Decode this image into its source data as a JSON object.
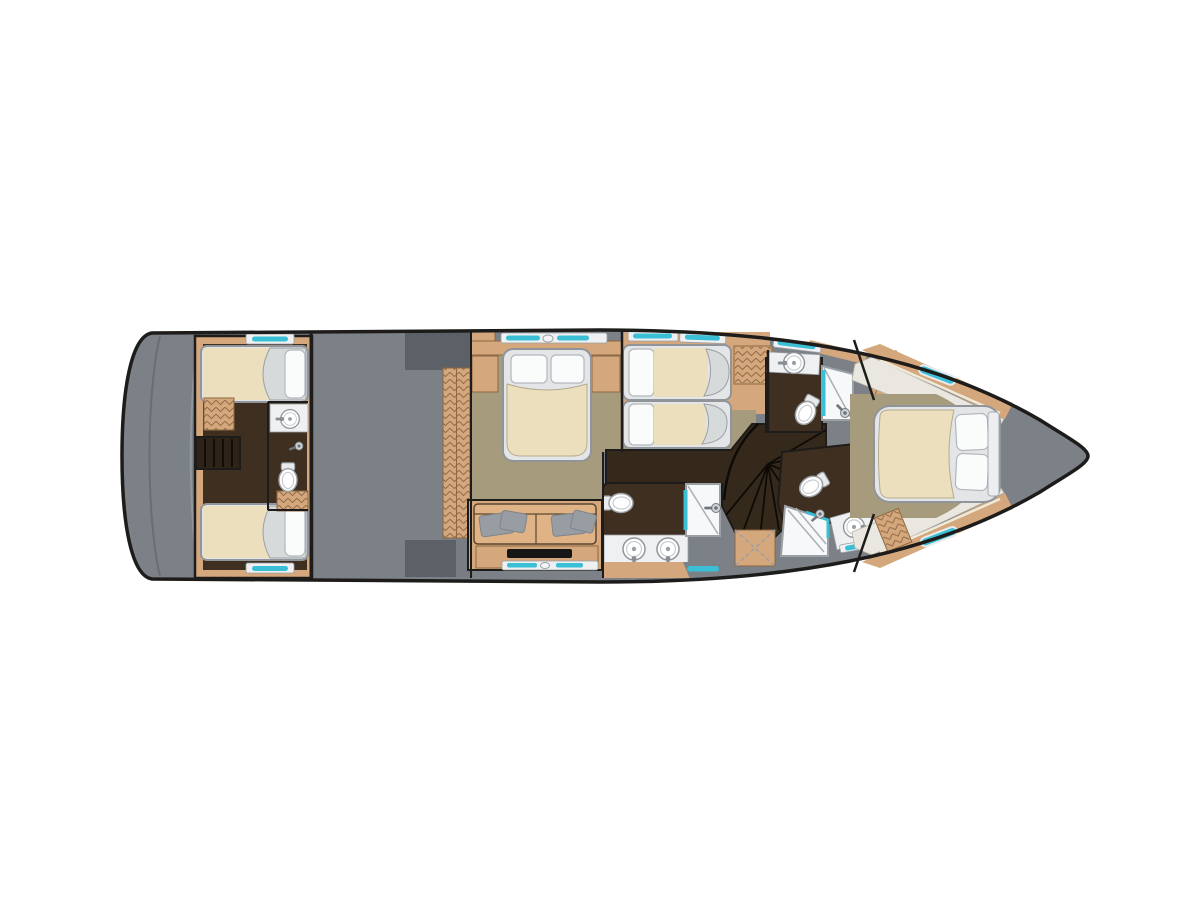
{
  "page": {
    "background": "#ffffff",
    "title": "yacht-lower-deck-floor-plan"
  },
  "colors": {
    "outline": "#1d1c1a",
    "deck": "#7b8187",
    "deck_dark": "#5c6167",
    "wood": "#d4a77c",
    "wood_edge": "#8c6844",
    "wood_light": "#e0b68c",
    "khaki": "#a69c7d",
    "dark_brown": "#3f2f20",
    "stair_brown": "#35291b",
    "beige": "#ecdfbe",
    "sheet": "#d7dadb",
    "sill": "#eef0f1",
    "fixture_edge": "#9aa0a5",
    "cyan": "#3bbfd6",
    "pillow": "#fafbfb",
    "gray_pillow": "#979da2",
    "sofa": "#e0b386",
    "tv": "#161616",
    "shelf": "#e9e7df"
  },
  "legend": {
    "orientation": "bow-right-stern-left",
    "rooms": [
      "swim-platform",
      "aft-guest-cabin-with-twin-singles-and-wc",
      "engine-room",
      "midship-master-cabin",
      "twin-guest-cabin",
      "forward-guest-bathroom",
      "day-head-bathroom",
      "vip-bathroom",
      "vip-bow-cabin",
      "spiral-staircase"
    ],
    "fixture_counts": {
      "beds": 6,
      "toilets": 4,
      "sinks": 5,
      "showers": 3,
      "wardrobes": 5,
      "window_accents": 14
    }
  }
}
